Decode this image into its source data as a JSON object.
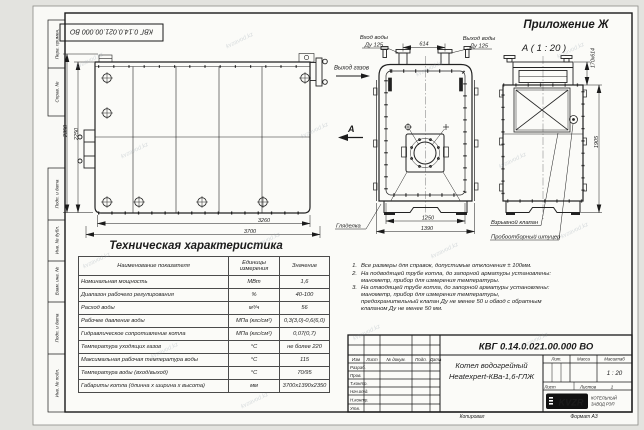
{
  "sheet": {
    "top_stamp": "КВГ 0.14.0.021.00.000 ВО",
    "appendix_label": "Приложение Ж",
    "detail_view_title": "А ( 1 : 20 )",
    "copied_label": "Копировал",
    "format_label": "Формат А3",
    "watermark": "kvzavod.kz"
  },
  "margin": {
    "perv_primen": "Перв. примен.",
    "sprav_no": "Справ. №",
    "podp_data_1": "Подп. и дата",
    "inv_dubl": "Инв. № дубл.",
    "vzam_inv": "Взам. инв. №",
    "podp_data_2": "Подп. и дата",
    "inv_podl": "Инв. № подл."
  },
  "labels": {
    "water_inlet_1": "Вход воды",
    "water_inlet_2": "Ду 125",
    "water_outlet_1": "Выход воды",
    "water_outlet_2": "Ду 125",
    "gas_outlet": "Выход газов",
    "view_letter": "А",
    "sight_glass": "Гляделка",
    "explosion_valve": "Взрывной клапан",
    "sampling_fitting": "Пробоотборный штуцер"
  },
  "dims": {
    "side_height_outer": "2350",
    "side_height_inner": "2250",
    "side_length_inner": "3260",
    "side_length_outer": "3700",
    "pipe_spacing": "614",
    "front_width_inner": "1250",
    "front_width_outer": "1390",
    "flue_section": "170х614",
    "detail_height": "1905"
  },
  "spec_table": {
    "title": "Техническая характеристика",
    "headers": [
      "Наименование показателя",
      "Единицы измерения",
      "Значение"
    ],
    "rows": [
      {
        "name": "Номинальная мощность",
        "unit": "МВт",
        "value": "1,6"
      },
      {
        "name": "Диапазон рабочего регулирования",
        "unit": "%",
        "value": "40-100"
      },
      {
        "name": "Расход воды",
        "unit": "м³/ч",
        "value": "56"
      },
      {
        "name": "Рабочее давление воды",
        "unit": "МПа (кгс/см²)",
        "value": "0,3(3,0)-0,6(6,0)"
      },
      {
        "name": "Гидравлическое сопротивление котла",
        "unit": "МПа (кгс/см²)",
        "value": "0,07(0,7)"
      },
      {
        "name": "Температура уходящих газов",
        "unit": "°С",
        "value": "не более 220"
      },
      {
        "name": "Максимальная рабочая температура воды",
        "unit": "°С",
        "value": "115"
      },
      {
        "name": "Температура воды (вход/выход)",
        "unit": "°С",
        "value": "70/95"
      },
      {
        "name": "Габариты котла (длинна х ширина х высота)",
        "unit": "мм",
        "value": "3700х1390х2350"
      }
    ]
  },
  "notes": {
    "items": [
      {
        "num": "1.",
        "text": "Все размеры для справок, допустимые отклонения ± 100мм."
      },
      {
        "num": "2.",
        "text": "На подводящей трубе котла, до запорной арматуры установлены: манометр, прибор для измерения температуры."
      },
      {
        "num": "3.",
        "text": "На отводящей трубе котла, до запорной арматуры установлены: манометр, прибор для измерения температуры, предохранительный клапан Ду не менее 50 и обвод с обратным клапаном Ду не менее 50 мм."
      }
    ]
  },
  "title_block": {
    "doc_number": "КВГ 0.14.0.021.00.000 ВО",
    "product_name_1": "Котел водогрейный",
    "product_name_2": "Heatexpert-КВа-1,6-ГЛЖ",
    "col_izm": "Изм",
    "col_list": "Лист",
    "col_doc": "№ докум.",
    "col_podp": "Подп.",
    "col_data": "Дата",
    "row_razrab": "Разраб.",
    "row_prov": "Пров.",
    "row_tkontr": "Т.контр.",
    "row_nachotd": "Нач.отд.",
    "row_nkontr": "Н.контр.",
    "row_utv": "Утв.",
    "lit_label": "Лит.",
    "mass_label": "Масса",
    "scale_label": "Масштаб",
    "scale_value": "1 : 20",
    "sheet_label": "Лист",
    "sheets_label": "Листов",
    "sheets_value": "1",
    "logo_text": "KVZR",
    "company_line_1": "КОТЕЛЬНЫЙ",
    "company_line_2": "ЗАВОД РЭП"
  }
}
